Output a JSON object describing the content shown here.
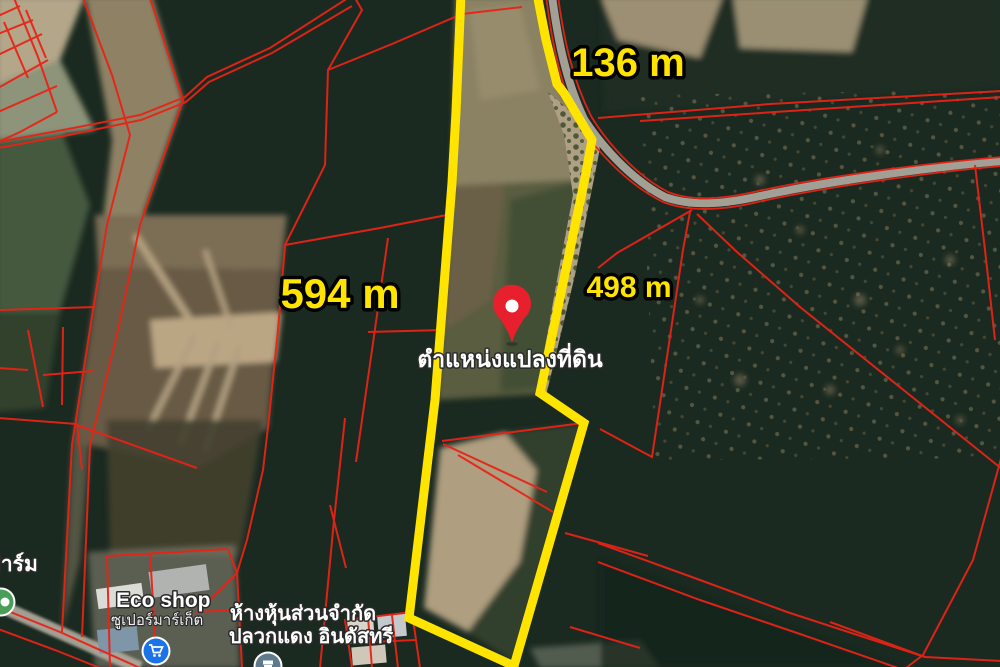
{
  "map": {
    "plot": {
      "outline_color": "#ffe400"
    },
    "dimension_labels": {
      "top": "136 m",
      "left": "594 m",
      "right": "498 m"
    },
    "pin": {
      "label": "ตำแหน่งแปลงที่ดิน",
      "color": "#e8202e"
    },
    "poi": {
      "eco_shop": {
        "name": "Eco shop",
        "category": "ซูเปอร์มาร์เก็ต",
        "icon": "shopping-cart-icon",
        "icon_color": "#1a73e8"
      },
      "company": {
        "name_line1": "ห้างหุ้นส่วนจำกัด",
        "name_line2": "ปลวกแดง อินดัสทรี",
        "icon": "store-icon",
        "icon_color": "#5f7c8c"
      },
      "farm": {
        "name": "ฟาร์ม",
        "icon": "farm-icon",
        "icon_color": "#4b9e57"
      }
    },
    "colors": {
      "parcel_line": "#e82317",
      "label_yellow": "#ffe400",
      "road": "#a29f95"
    }
  }
}
